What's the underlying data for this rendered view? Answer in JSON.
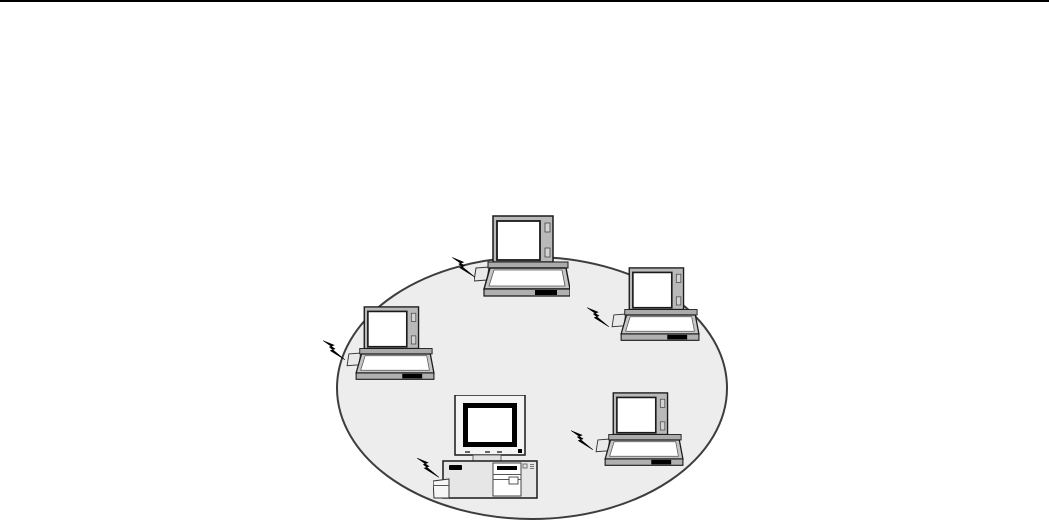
{
  "meta": {
    "description": "Ad-hoc wireless network diagram: four laptops and one desktop PC with wireless signal bolts, grouped inside a shaded ellipse on a white document page with a black rule at top"
  },
  "colors": {
    "page_bg": "#ffffff",
    "top_rule": "#000000",
    "ellipse_fill": "#ededed",
    "ellipse_stroke": "#3d3d3d",
    "outline": "#1a1a1a",
    "laptop_lid": "#b9b9b9",
    "laptop_deck": "#c6c6c6",
    "laptop_front": "#b0b0b0",
    "screen_white": "#ffffff",
    "accent_black": "#000000",
    "case_gray": "#e6e6e6",
    "card_gray": "#e9e9e9"
  },
  "diagram": {
    "canvas": {
      "width": 1049,
      "height": 524
    },
    "ellipse": {
      "cx": 532,
      "cy": 388,
      "rx": 195,
      "ry": 131
    },
    "nodes": [
      {
        "id": "laptop-top",
        "type": "laptop",
        "x": 474,
        "y": 215,
        "w": 96,
        "h": 84
      },
      {
        "id": "laptop-right",
        "type": "laptop",
        "x": 610,
        "y": 267,
        "w": 91,
        "h": 76
      },
      {
        "id": "laptop-left",
        "type": "laptop",
        "x": 345,
        "y": 306,
        "w": 91,
        "h": 76
      },
      {
        "id": "laptop-bottom-right",
        "type": "laptop",
        "x": 594,
        "y": 392,
        "w": 91,
        "h": 76
      },
      {
        "id": "desktop-pc",
        "type": "desktop",
        "x": 433,
        "y": 395,
        "w": 105,
        "h": 104
      }
    ],
    "signals": [
      {
        "id": "signal-laptop-top",
        "x": 452,
        "y": 251,
        "w": 23,
        "h": 26
      },
      {
        "id": "signal-laptop-right",
        "x": 587,
        "y": 301,
        "w": 22,
        "h": 26
      },
      {
        "id": "signal-laptop-left",
        "x": 323,
        "y": 334,
        "w": 22,
        "h": 26
      },
      {
        "id": "signal-laptop-bottom-right",
        "x": 571,
        "y": 424,
        "w": 22,
        "h": 26
      },
      {
        "id": "signal-desktop-pc",
        "x": 417,
        "y": 451,
        "w": 22,
        "h": 27
      }
    ]
  }
}
